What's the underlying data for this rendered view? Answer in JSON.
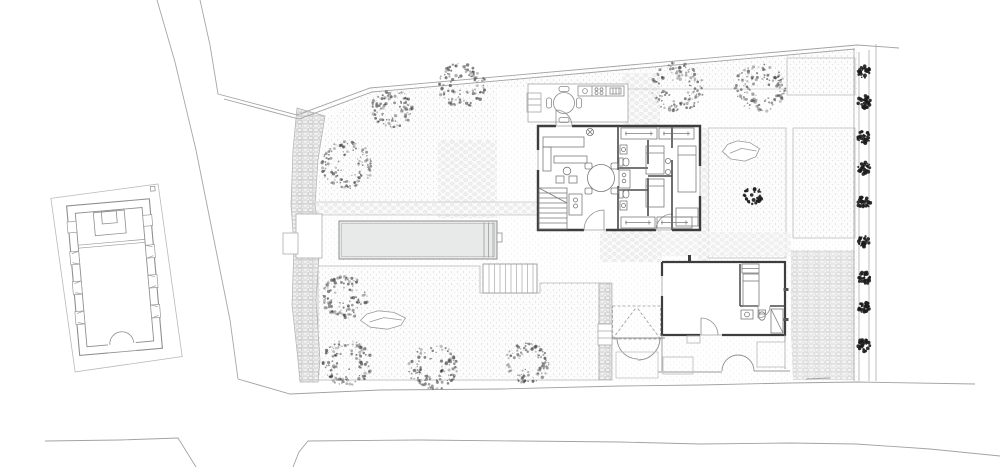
{
  "document": {
    "kind": "architectural-site-plan",
    "view": "ground-floor plan with gardens",
    "visible_text_labels": []
  },
  "canvas": {
    "width": 1000,
    "height": 467,
    "background": "#ffffff"
  },
  "palette": {
    "paper": "#ffffff",
    "line": "#a2a2a2",
    "line_light": "#c4c4c4",
    "wall": "#3d3d3d",
    "partition": "#4a4a4a",
    "furniture": "#7a7a7a",
    "pool_water": "#e8eaea",
    "tree_canopy": "#4f4f4f",
    "tree_dark": "#1c1c1c",
    "stone": "#bfbfbf",
    "stipple_dot": "#cdcdcd"
  },
  "site": {
    "buildings": [
      {
        "id": "chapel",
        "desc": "small thick-walled chapel west of the road, entrance with double-leaf door at south, altar niche at north"
      },
      {
        "id": "main-house",
        "desc": "main house with open terrace and outdoor kitchen at north, living room with dining table and stair, bathroom core and two bedrooms, master room at east"
      },
      {
        "id": "annex",
        "desc": "guest annex at the street with bed, kitchenette and bathroom, arched porch openings to street"
      }
    ],
    "features": [
      {
        "id": "pool",
        "desc": "long rectangular swimming pool with steps at east end"
      },
      {
        "id": "boundary-wall-west",
        "desc": "stone rubble wall along the west boundary"
      },
      {
        "id": "tree-row-east",
        "desc": "row of 9 clipped trees along the east boundary fence"
      },
      {
        "id": "garden-upper",
        "desc": "upper lawn with 5 large trees"
      },
      {
        "id": "garden-lower",
        "desc": "lower lawn with 4 large trees and a rock"
      },
      {
        "id": "courtyard-beds",
        "desc": "two gravel planting beds east of the house, one with rock and small tree"
      },
      {
        "id": "entry-gate",
        "desc": "gated entry with dashed canopy and double-swing door"
      },
      {
        "id": "road-west",
        "desc": "road running north-south on the west side"
      },
      {
        "id": "street-south",
        "desc": "street along the south edge"
      }
    ],
    "counts": {
      "large_trees": 9,
      "row_trees": 9,
      "small_dark_trees": 1,
      "rocks": 2
    }
  },
  "pool": {
    "x": 339,
    "y": 221,
    "w": 158,
    "h": 38,
    "inset": 2.5,
    "step_lines": [
      484,
      488.5,
      493
    ],
    "ladder": {
      "x": 497,
      "y": 233,
      "w": 5,
      "h": 9
    }
  },
  "trees": {
    "canopy": [
      {
        "x": 347,
        "y": 165,
        "r": 26
      },
      {
        "x": 392,
        "y": 108,
        "r": 21
      },
      {
        "x": 462,
        "y": 85,
        "r": 24
      },
      {
        "x": 677,
        "y": 87,
        "r": 27
      },
      {
        "x": 760,
        "y": 88,
        "r": 26
      },
      {
        "x": 345,
        "y": 297,
        "r": 23
      },
      {
        "x": 347,
        "y": 363,
        "r": 25
      },
      {
        "x": 433,
        "y": 367,
        "r": 25
      },
      {
        "x": 527,
        "y": 363,
        "r": 22
      }
    ],
    "dark": [
      {
        "x": 753,
        "y": 196,
        "r": 11
      }
    ],
    "row": {
      "x": 864,
      "r": 7.5,
      "ys": [
        72,
        102,
        137,
        168,
        203,
        242,
        278,
        308,
        345
      ]
    }
  },
  "rocks": [
    {
      "x": 741,
      "y": 151,
      "w": 37,
      "h": 22
    },
    {
      "x": 383,
      "y": 320,
      "w": 45,
      "h": 20
    }
  ]
}
